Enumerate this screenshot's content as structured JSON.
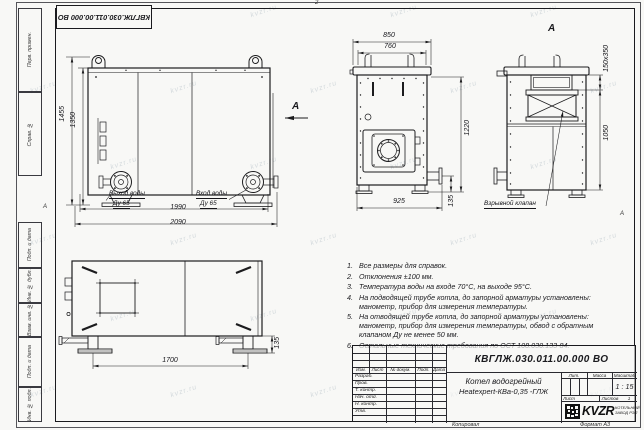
{
  "sheet": {
    "stamp_rotated": "КВГЛЖ.030.011.00.000 ВО",
    "fold_mark_top": "2",
    "zone_mark_left": "А",
    "zone_mark_right": "А",
    "watermark": "kvzr.ru",
    "margin_labels": {
      "perv_primen": "Перв. примен.",
      "sprav_no": "Справ. №",
      "podp_data_1": "Подп. и дата",
      "inv_dubl": "Инв. № дубл.",
      "vzam_inv": "Взам. инв. №",
      "podp_data_2": "Подп. и дата",
      "inv_podl": "Инв. № подл.",
      "kopiroval": "Копировал",
      "format": "Формат А3"
    }
  },
  "views": {
    "front": {
      "dim_height_outer": "1455",
      "dim_height_inner": "1350",
      "dim_width_inner": "1990",
      "dim_width_outer": "2090",
      "outlet_label_1": "Выход воды",
      "outlet_label_2": "Ду 65",
      "inlet_label_1": "Вход воды",
      "inlet_label_2": "Ду 65",
      "view_arrow": "А"
    },
    "side": {
      "dim_top_outer": "850",
      "dim_top_inner": "760",
      "dim_height": "1220",
      "dim_bottom": "925",
      "dim_stub": "135"
    },
    "view_a": {
      "title": "А",
      "dim_flue": "150х350",
      "dim_height": "1050",
      "valve_label": "Взрывной клапан"
    },
    "top": {
      "dim_feet": "1700",
      "dim_foot_height": "135"
    }
  },
  "notes": [
    {
      "n": "1.",
      "text": "Все размеры для справок."
    },
    {
      "n": "2.",
      "text": "Отклонения ±100 мм."
    },
    {
      "n": "3.",
      "text": "Температура воды на входе 70°С, на выходе 95°С."
    },
    {
      "n": "4.",
      "text": "На подводящей трубе котла, до запорной арматуры установлены:\nманометр, прибор для измерения температуры."
    },
    {
      "n": "5.",
      "text": "На отводящей трубе котла, до запорной арматуры установлены:\nманометр, прибор для измерения температуры, обвод с обратным\nклапаном Ду не менее 50 мм."
    },
    {
      "n": "6.",
      "text": "Остальные технические требования по ОСТ 108.030.133-84."
    }
  ],
  "title_block": {
    "doc_number": "КВГЛЖ.030.011.00.000 ВО",
    "product_line1": "Котел водогрейный",
    "product_line2": "Heatexpert-КВа-0,35 -ГЛЖ",
    "cols": {
      "izm": "Изм.",
      "list": "Лист",
      "doc": "№ докум.",
      "podp": "Подп.",
      "data": "Дата"
    },
    "rows": [
      "Разраб.",
      "Пров.",
      "Т. контр.",
      "Нач. отд.",
      "Н. контр.",
      "Утв."
    ],
    "lit": "Лит.",
    "massa": "Масса",
    "masshtab": "Масштаб",
    "scale_value": "1 : 15",
    "list_label": "Лист",
    "listov_label": "Листов",
    "listov_value": "1",
    "logo_text": "KVZR",
    "company_line1": "КОТЕЛЬНЫЙ",
    "company_line2": "ЗАВОД РЭП"
  }
}
